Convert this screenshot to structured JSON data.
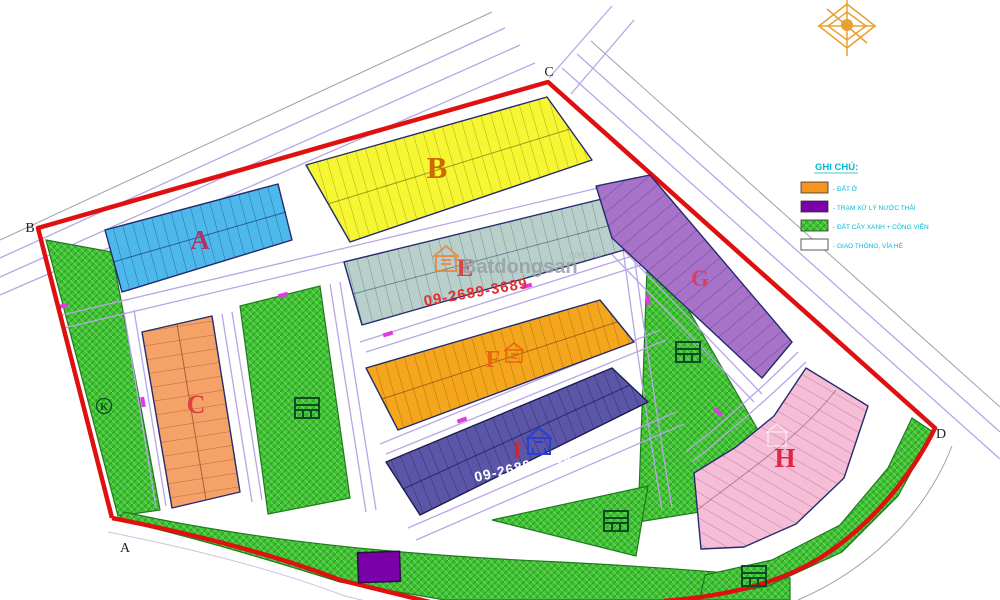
{
  "blocks": [
    {
      "letter": "A",
      "color": "#4cb9ea",
      "letter_color": "#b03564"
    },
    {
      "letter": "B",
      "color": "#f6f632",
      "letter_color": "#cc6a00"
    },
    {
      "letter": "C",
      "color": "#f4a268",
      "letter_color": "#e04040"
    },
    {
      "letter": "E",
      "color": "#b9cfca",
      "letter_color": "#d94444"
    },
    {
      "letter": "F",
      "color": "#f4a61d",
      "letter_color": "#e8650d"
    },
    {
      "letter": "G",
      "color": "#a673c8",
      "letter_color": "#d94060"
    },
    {
      "letter": "H",
      "color": "#f5bed6",
      "letter_color": "#e02545"
    },
    {
      "letter": "I",
      "color": "#5c56a9",
      "letter_color": "#dd2222"
    }
  ],
  "road_labels": {
    "left": "B",
    "top": "C",
    "right": "D",
    "bottom": "A",
    "park": "K"
  },
  "legend": {
    "title": "GHI CHÚ:",
    "items": [
      {
        "label": "- ĐẤT Ở",
        "color": "#f5941f"
      },
      {
        "label": "- TRẠM XỬ LÝ NƯỚC THẢI",
        "color": "#7a00a8"
      },
      {
        "label": "- ĐẤT CÂY XANH + CÔNG VIÊN",
        "color": "#3ec331"
      },
      {
        "label": "- GIAO THÔNG, VỈA HÈ",
        "color": "#ffffff"
      }
    ]
  },
  "watermark": {
    "brand": "Batdongsan",
    "suffix": ".com.vn",
    "phone": "09-2689-3689"
  },
  "compass": {
    "label": "north-arrow",
    "color": "#e8a030"
  },
  "boundary_color": "#de1010"
}
